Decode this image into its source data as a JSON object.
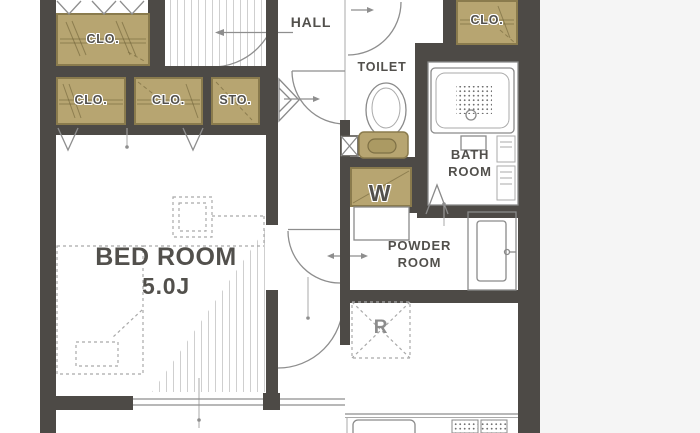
{
  "colors": {
    "wall": "#4d4a46",
    "closet_fill": "#b7a571",
    "closet_stroke": "#8a7b4d",
    "line": "#8e8e8e",
    "light_line": "#aaaaaa",
    "label": "#52504c",
    "muted_label": "#8c8c8c",
    "hatch": "#cfcfcf",
    "outside": "#f5f5f5"
  },
  "rooms": {
    "hall": {
      "label": "HALL"
    },
    "toilet": {
      "label": "TOILET"
    },
    "bathroom": {
      "line1": "BATH",
      "line2": "ROOM"
    },
    "powder_room": {
      "line1": "POWDER",
      "line2": "ROOM"
    },
    "bedroom": {
      "label": "BED ROOM",
      "size": "5.0J"
    }
  },
  "storage": {
    "closet_top": {
      "label": "CLO."
    },
    "closet_left": {
      "label": "CLO."
    },
    "closet_mid": {
      "label": "CLO."
    },
    "storage_unit": {
      "label": "STO."
    },
    "closet_entry": {
      "label": "CLO."
    }
  },
  "appliances": {
    "washer": {
      "label": "W"
    },
    "refrigerator": {
      "label": "R"
    }
  }
}
